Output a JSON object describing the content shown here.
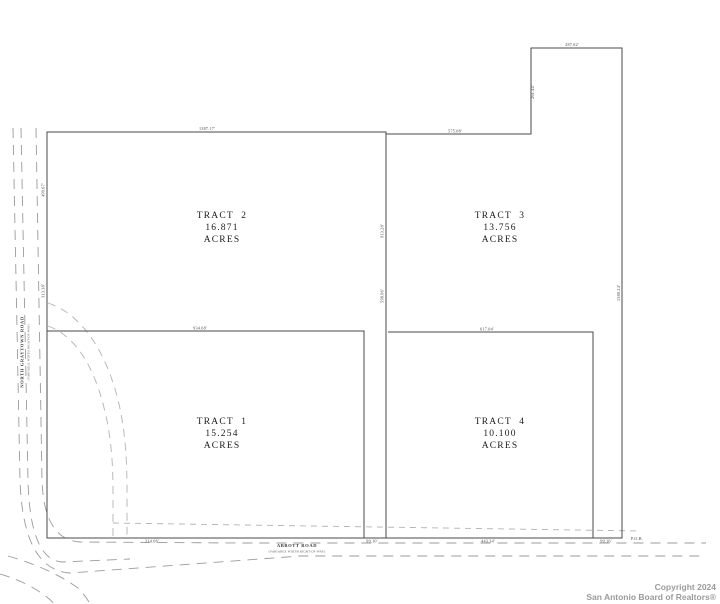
{
  "page": {
    "background": "#ffffff",
    "line_color": "#4a4a4a",
    "dash_color": "#9b9b9b",
    "easement_dash_color": "#b3b3b3",
    "copyright_color": "#9b9b9b"
  },
  "plat": {
    "tracts": [
      {
        "name": "TRACT 1",
        "acreage": "15.254",
        "unit": "ACRES"
      },
      {
        "name": "TRACT 2",
        "acreage": "16.871",
        "unit": "ACRES"
      },
      {
        "name": "TRACT 3",
        "acreage": "13.756",
        "unit": "ACRES"
      },
      {
        "name": "TRACT 4",
        "acreage": "10.100",
        "unit": "ACRES"
      }
    ],
    "roads": {
      "west": {
        "name": "NORTH GRAYTOWN ROAD",
        "row": "(VARIABLE WIDTH RIGHT-OF-WAY)"
      },
      "south": {
        "name": "ABBOTT ROAD",
        "row": "(VARIABLE WIDTH RIGHT-OF-WAY)"
      }
    },
    "dimensions": {
      "notch_top": "287.62'",
      "notch_west": "261.44'",
      "north_west_segment": "1387.17'",
      "north_east_segment": "575.08'",
      "west_upper": "499.67'",
      "west_lower": "313.38'",
      "divider_upper": "913.28'",
      "divider_lower": "598.06'",
      "east_side": "1380.24'",
      "tract1_north": "934.68'",
      "tract4_north": "617.04'",
      "south_a": "314.06'",
      "south_b": "99.10'",
      "south_c": "443.34'",
      "south_d": "99.16'",
      "pob": "P.O.B."
    }
  },
  "footer": {
    "copyright_line1": "Copyright 2024",
    "copyright_line2": "San Antonio Board of Realtors®"
  }
}
